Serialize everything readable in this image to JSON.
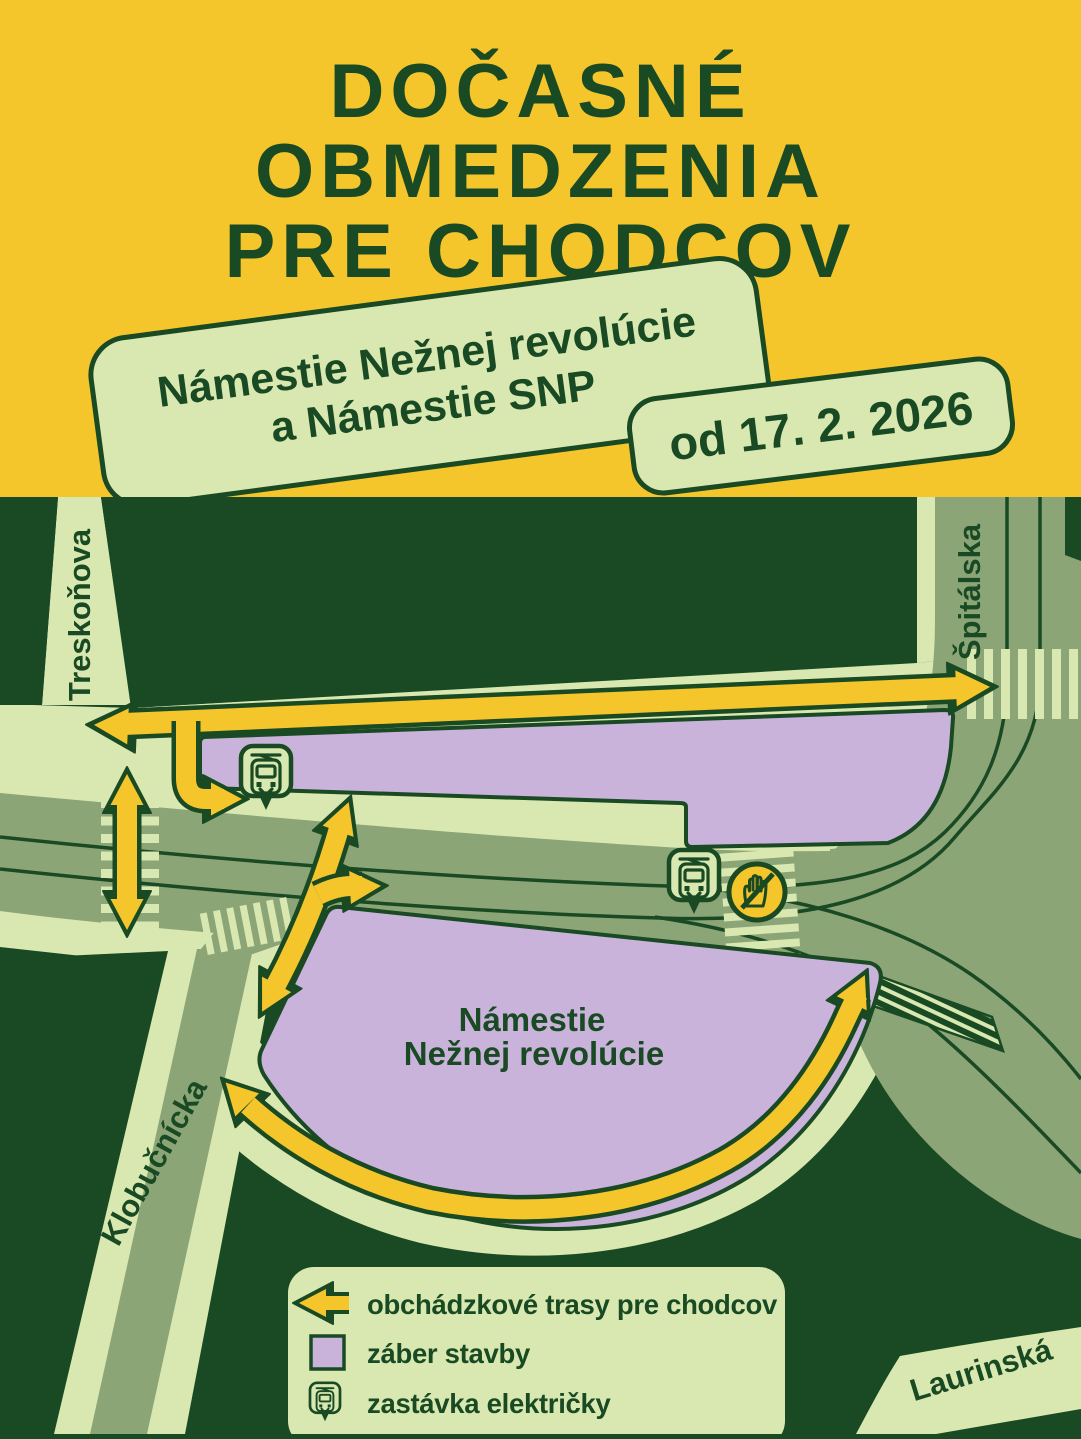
{
  "colors": {
    "yellow": "#F5C62C",
    "dark_green": "#194A23",
    "light_green": "#D9E8B1",
    "sage_green": "#8BA577",
    "purple": "#C9B3DB"
  },
  "header": {
    "title_lines": [
      "DOČASNÉ",
      "OBMEDZENIA",
      "PRE CHODCOV"
    ],
    "location_badge": {
      "line1": "Námestie Nežnej revolúcie",
      "line2": "a Námestie SNP"
    },
    "date_badge": "od 17. 2. 2026"
  },
  "map": {
    "streets": {
      "treskonova": "Treskoňova",
      "spitalska": "Špitálska",
      "klobucnicka": "Klobučnícka",
      "laurinska": "Laurinská"
    },
    "construction_area_label": {
      "line1": "Námestie",
      "line2": "Nežnej revolúcie"
    }
  },
  "legend": {
    "items": [
      {
        "icon": "detour-arrow-icon",
        "label": "obchádzkové trasy pre chodcov"
      },
      {
        "icon": "construction-area-swatch",
        "label": "záber stavby"
      },
      {
        "icon": "tram-stop-icon",
        "label": "zastávka električky"
      }
    ]
  }
}
